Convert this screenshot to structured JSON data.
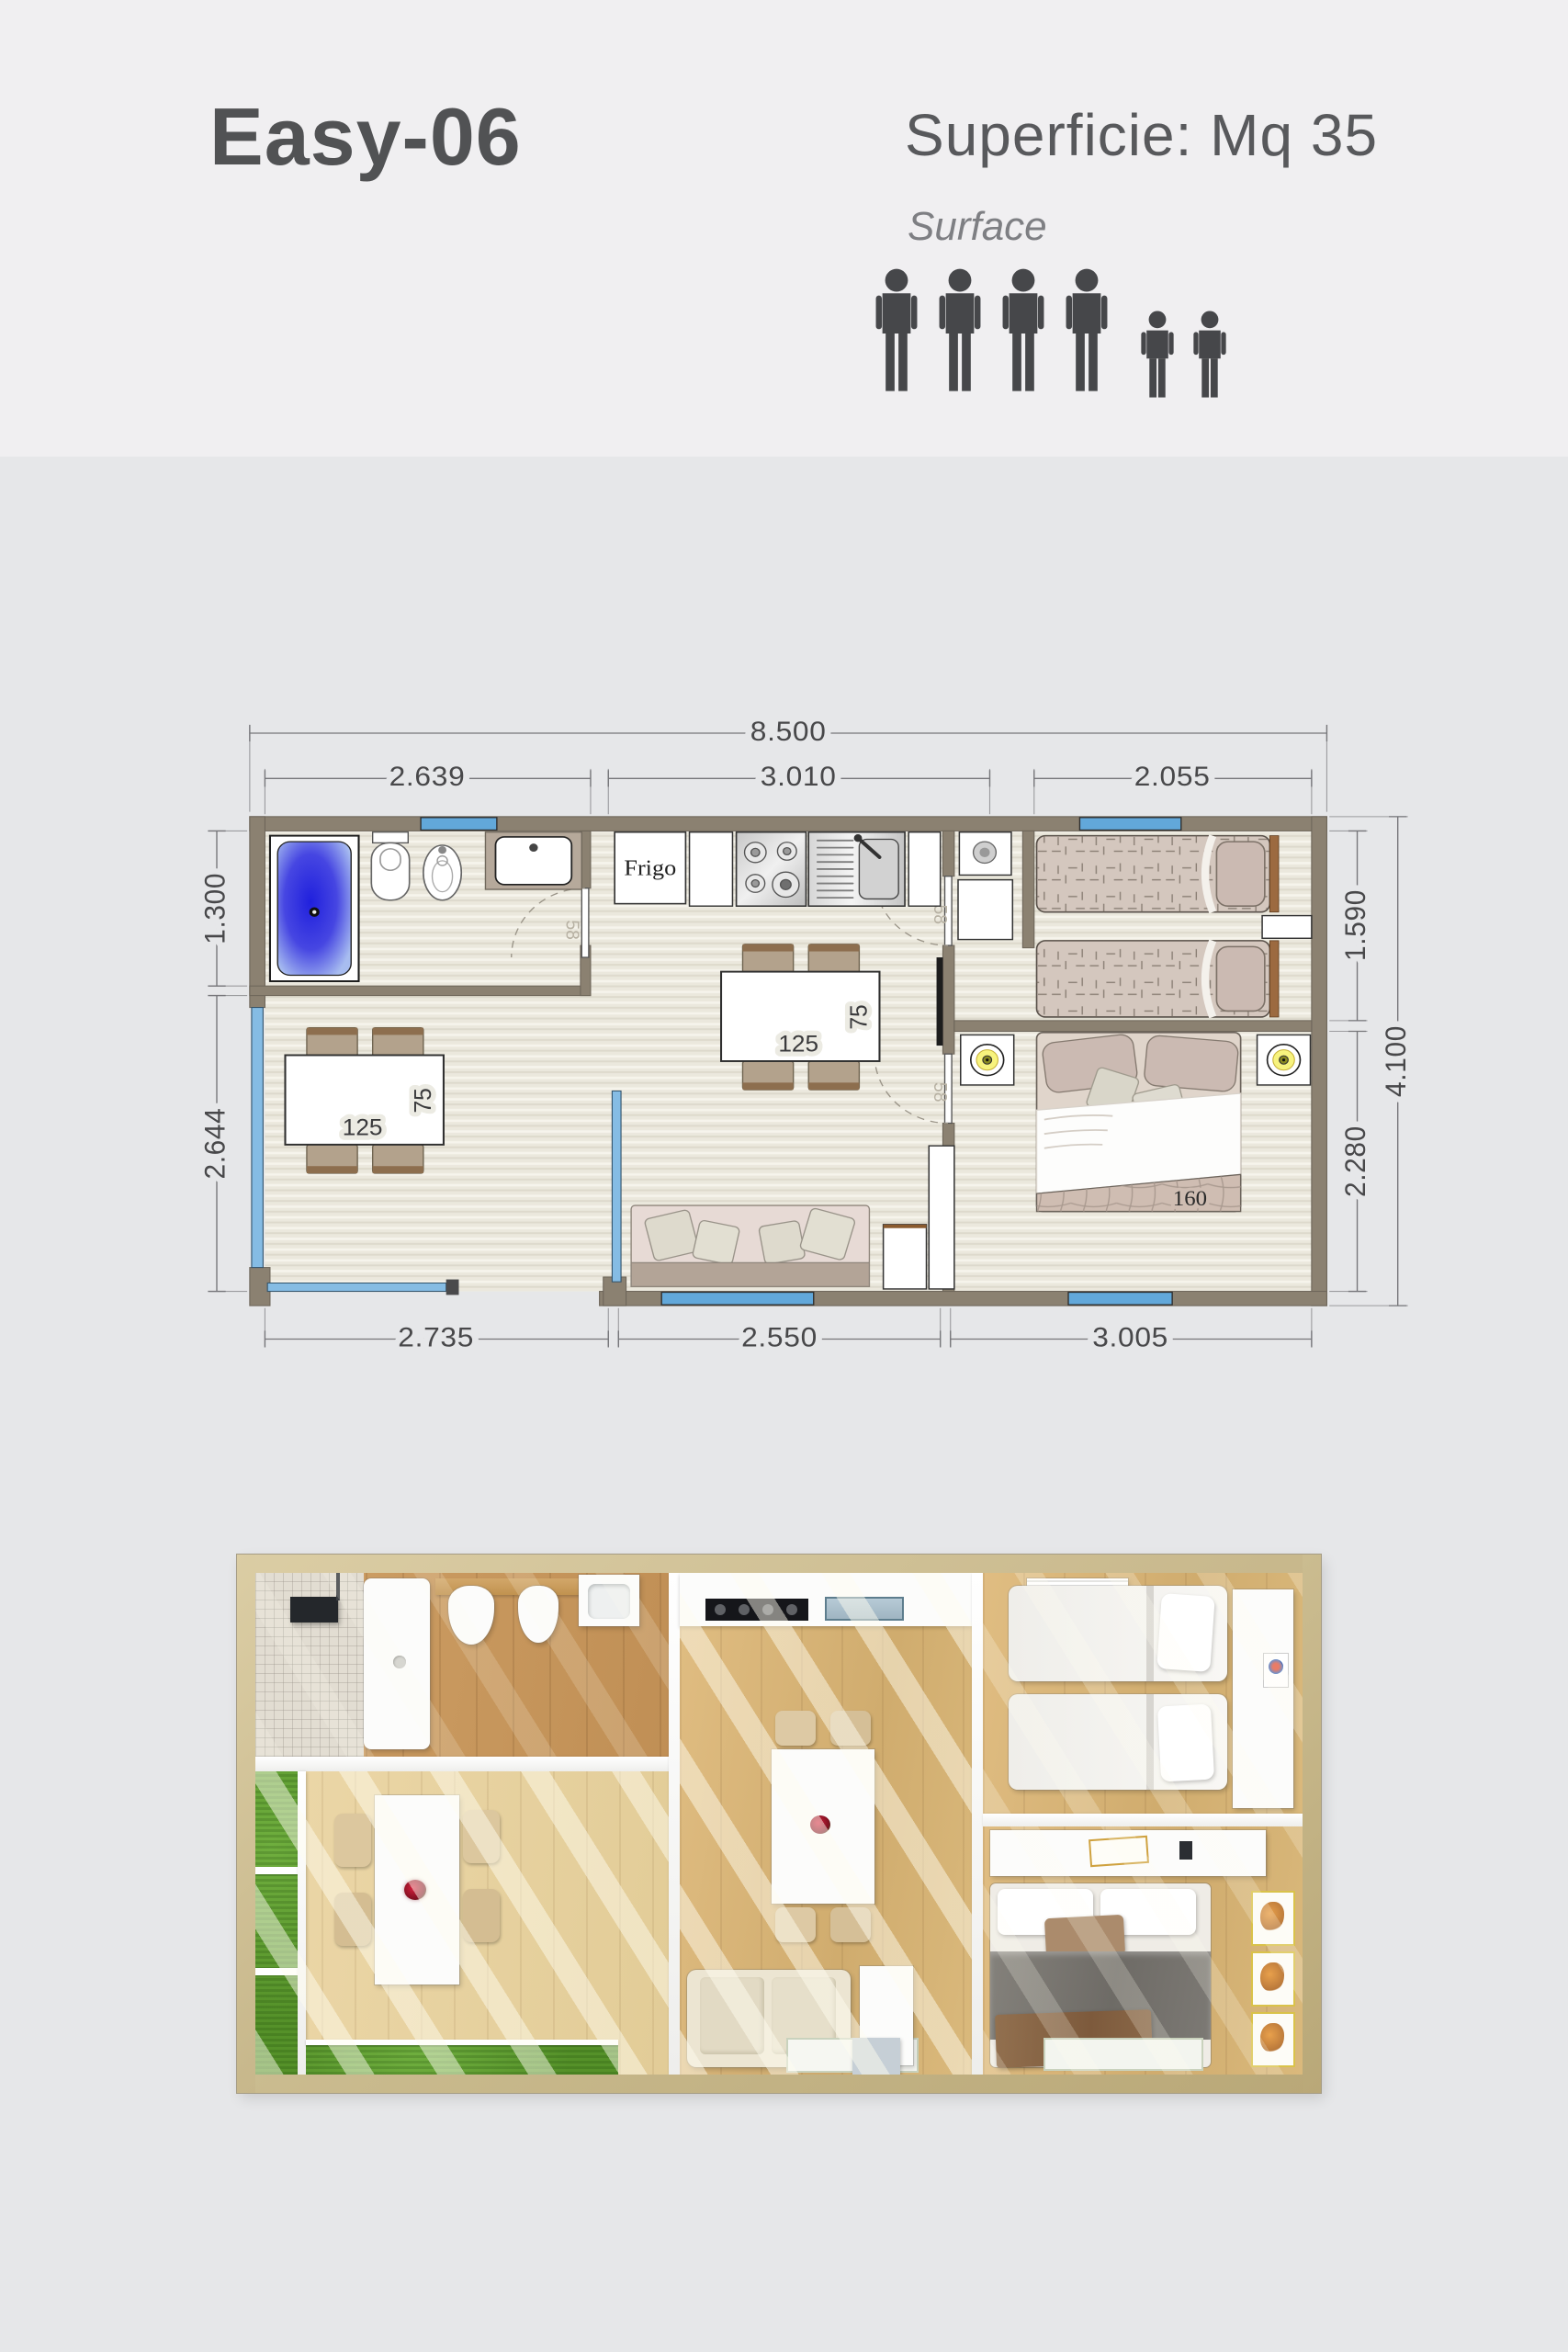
{
  "header": {
    "model": "Easy-06",
    "surface_label_it": "Superficie: Mq 35",
    "surface_label_en": "Surface",
    "occupancy": {
      "adults": 4,
      "children": 2
    }
  },
  "plan": {
    "dims": {
      "top_total": "8.500",
      "top_bath": "2.639",
      "top_kitchen": "3.010",
      "top_twin": "2.055",
      "left_bath": "1.300",
      "left_terrace": "2.644",
      "right_twin": "1.590",
      "right_master": "2.280",
      "right_total": "4.100",
      "bottom_terrace": "2.735",
      "bottom_living": "2.550",
      "bottom_master": "3.005"
    },
    "labels": {
      "fridge": "Frigo",
      "door_width": "58",
      "table_length": "125",
      "table_depth": "75",
      "bed_width": "160"
    },
    "colors": {
      "wall": "#8b8171",
      "window": "#62a8da",
      "glass": "#85bce4",
      "header_bg": "#f0eff1",
      "body_bg": "#e6e7e9"
    }
  }
}
